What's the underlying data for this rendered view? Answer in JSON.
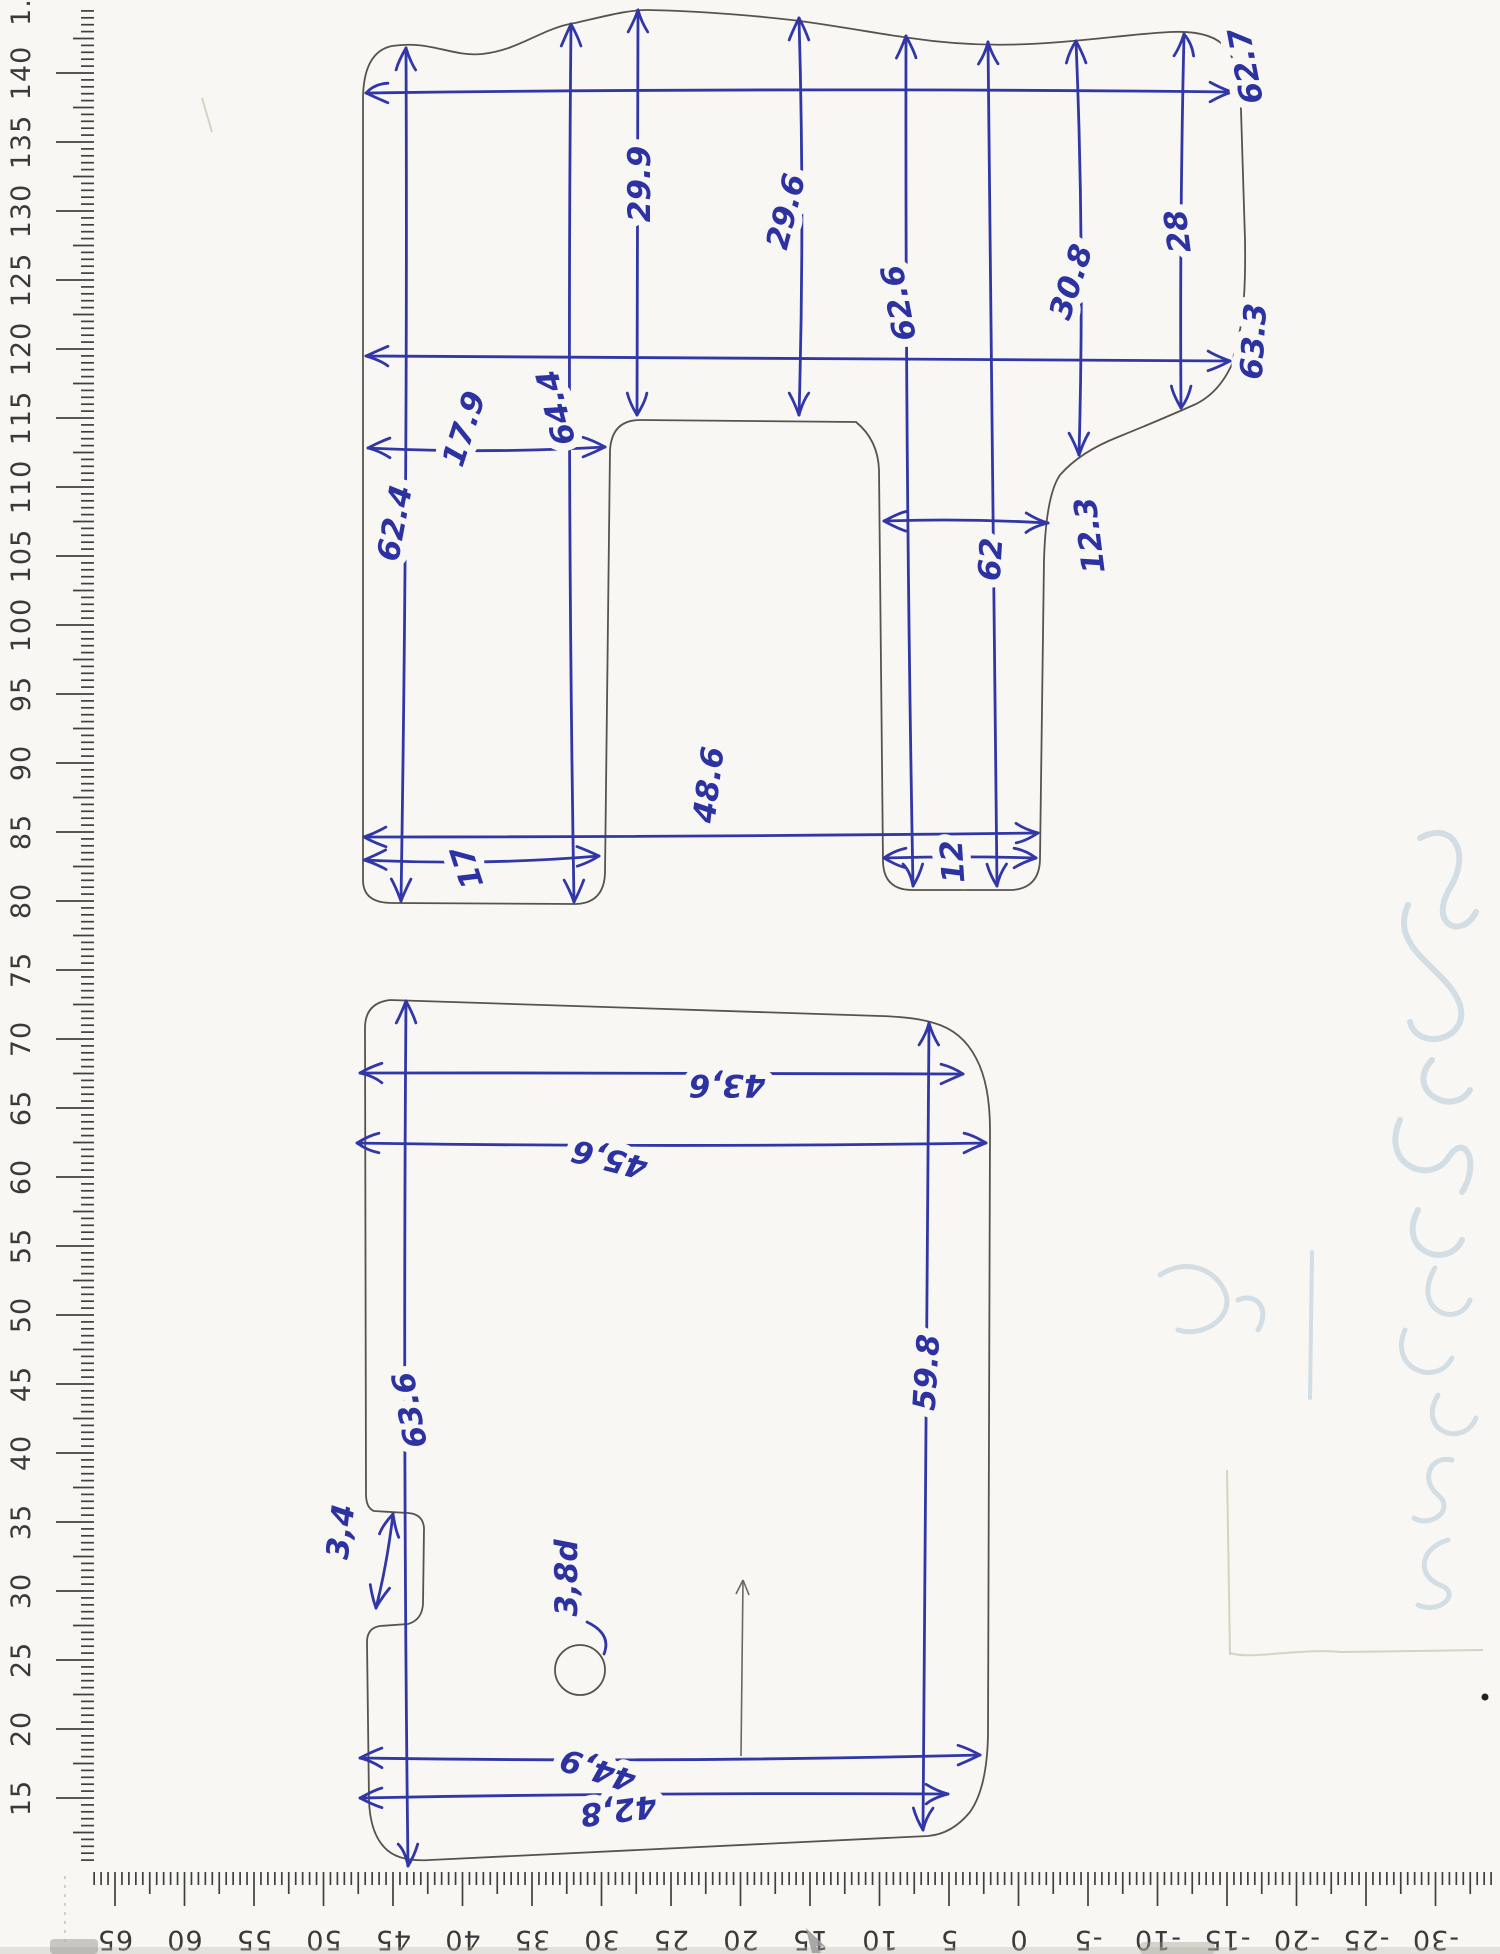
{
  "document": {
    "kind": "scanned hand-drawn template sketch with two outlined parts, dimension arrows and two measuring rulers",
    "ink_color": "#3137a6",
    "pencil_color": "#57544e",
    "paper_color": "#f8f7f3"
  },
  "left_ruler": {
    "orientation": "vertical",
    "partial_top_label": "1",
    "first_value": 140,
    "last_value": 15,
    "step": -5,
    "y_of_first": 73,
    "px_per_unit": 13.8,
    "tick_edge_x": 94,
    "numbers_x": 30,
    "label_rotation": -90,
    "values": [
      140,
      135,
      130,
      125,
      120,
      115,
      110,
      105,
      100,
      95,
      90,
      85,
      80,
      75,
      70,
      65,
      60,
      55,
      50,
      45,
      40,
      35,
      30,
      25,
      20,
      15
    ]
  },
  "bottom_ruler": {
    "orientation": "horizontal",
    "first_value": 65,
    "last_value": -30,
    "step": -5,
    "x_of_45": 393,
    "px_per_unit": 13.9,
    "baseline_y": 1872,
    "numbers_y": 1931,
    "label_rotation": 180,
    "values": [
      65,
      60,
      55,
      50,
      45,
      40,
      35,
      30,
      25,
      20,
      15,
      10,
      5,
      0,
      -5,
      -10,
      -15,
      -20,
      -25,
      -30
    ]
  },
  "top_shape": {
    "name": "upper template outline with slot and two feet",
    "dimensions": [
      {
        "id": "width-top",
        "value": "62.7",
        "x1": 366,
        "y1": 93,
        "x2": 1232,
        "y2": 92,
        "label": {
          "x": 1256,
          "y": 64,
          "rot": -90
        },
        "break": false
      },
      {
        "id": "width-mid",
        "value": "63.3",
        "x1": 366,
        "y1": 356,
        "x2": 1230,
        "y2": 361,
        "label": {
          "x": 1264,
          "y": 342,
          "rot": -90
        },
        "break": false
      },
      {
        "id": "edge-to-slot",
        "value": "17.9",
        "x1": 368,
        "y1": 448,
        "x2": 605,
        "y2": 447,
        "label": {
          "x": 474,
          "y": 432,
          "rot": -90
        },
        "break": true
      },
      {
        "id": "foot2-top-w",
        "value": "12.3",
        "x1": 884,
        "y1": 521,
        "x2": 1048,
        "y2": 523,
        "label": {
          "x": 1100,
          "y": 534,
          "rot": -90
        },
        "break": false
      },
      {
        "id": "width-feet",
        "value": "48.6",
        "x1": 364,
        "y1": 837,
        "x2": 1038,
        "y2": 833,
        "label": {
          "x": 719,
          "y": 786,
          "rot": -90
        },
        "break": true
      },
      {
        "id": "foot1-width",
        "value": "17",
        "x1": 364,
        "y1": 860,
        "x2": 599,
        "y2": 856,
        "label": {
          "x": 477,
          "y": 864,
          "rot": -90
        },
        "break": true
      },
      {
        "id": "foot2-width",
        "value": "12",
        "x1": 884,
        "y1": 858,
        "x2": 1036,
        "y2": 858,
        "label": {
          "x": 963,
          "y": 861,
          "rot": -90
        },
        "break": true
      },
      {
        "id": "height-1",
        "value": "62.4",
        "x1": 406,
        "y1": 48,
        "x2": 401,
        "y2": 901,
        "label": {
          "x": 405,
          "y": 525,
          "rot": -90
        },
        "break": true
      },
      {
        "id": "height-2",
        "value": "64.4",
        "x1": 571,
        "y1": 24,
        "x2": 574,
        "y2": 902,
        "label": {
          "x": 566,
          "y": 405,
          "rot": -90
        },
        "break": true
      },
      {
        "id": "top-to-slot-1",
        "value": "29.9",
        "x1": 638,
        "y1": 10,
        "x2": 637,
        "y2": 415,
        "label": {
          "x": 650,
          "y": 184,
          "rot": -90
        },
        "break": true
      },
      {
        "id": "top-to-slot-2",
        "value": "29.6",
        "x1": 799,
        "y1": 18,
        "x2": 799,
        "y2": 415,
        "label": {
          "x": 796,
          "y": 214,
          "rot": -90
        },
        "break": true
      },
      {
        "id": "height-3",
        "value": "62.6",
        "x1": 906,
        "y1": 36,
        "x2": 913,
        "y2": 886,
        "label": {
          "x": 909,
          "y": 301,
          "rot": -90
        },
        "break": true
      },
      {
        "id": "height-4",
        "value": "62",
        "x1": 988,
        "y1": 42,
        "x2": 997,
        "y2": 886,
        "label": {
          "x": 1001,
          "y": 560,
          "rot": -90
        },
        "break": true
      },
      {
        "id": "top-to-curve-1",
        "value": "30.8",
        "x1": 1076,
        "y1": 41,
        "x2": 1079,
        "y2": 455,
        "label": {
          "x": 1081,
          "y": 285,
          "rot": -90
        },
        "break": true
      },
      {
        "id": "top-to-curve-2",
        "value": "28",
        "x1": 1184,
        "y1": 34,
        "x2": 1181,
        "y2": 408,
        "label": {
          "x": 1188,
          "y": 230,
          "rot": -90
        },
        "break": true
      }
    ]
  },
  "bottom_shape": {
    "name": "lower template outline with side notch and round hole",
    "dimensions": [
      {
        "id": "width-top-1",
        "value": "43,6",
        "x1": 360,
        "y1": 1073,
        "x2": 963,
        "y2": 1074,
        "label": {
          "x": 727,
          "y": 1075,
          "rot": 180
        },
        "break": true
      },
      {
        "id": "width-top-2",
        "value": "45,6",
        "x1": 357,
        "y1": 1143,
        "x2": 986,
        "y2": 1143,
        "label": {
          "x": 612,
          "y": 1149,
          "rot": 180
        },
        "break": true
      },
      {
        "id": "height-left",
        "value": "63.6",
        "x1": 406,
        "y1": 1001,
        "x2": 408,
        "y2": 1866,
        "label": {
          "x": 420,
          "y": 1408,
          "rot": -90
        },
        "break": true
      },
      {
        "id": "height-right",
        "value": "59.8",
        "x1": 929,
        "y1": 1023,
        "x2": 923,
        "y2": 1830,
        "label": {
          "x": 937,
          "y": 1373,
          "rot": -90
        },
        "break": true
      },
      {
        "id": "width-bottom-1",
        "value": "44,9",
        "x1": 360,
        "y1": 1758,
        "x2": 980,
        "y2": 1755,
        "label": {
          "x": 601,
          "y": 1760,
          "rot": 180
        },
        "break": true
      },
      {
        "id": "width-bottom-2",
        "value": "42,8",
        "x1": 360,
        "y1": 1798,
        "x2": 948,
        "y2": 1794,
        "label": {
          "x": 617,
          "y": 1800,
          "rot": 180
        },
        "break": true
      },
      {
        "id": "notch-size",
        "value": "3,4",
        "x1": 393,
        "y1": 1514,
        "x2": 376,
        "y2": 1608,
        "label": {
          "x": 351,
          "y": 1533,
          "rot": -90
        },
        "break": false
      }
    ],
    "hole": {
      "cx": 580,
      "cy": 1670,
      "r": 25,
      "label": "3,8d",
      "label_x": 577,
      "label_y": 1578,
      "label_rot": -90
    }
  },
  "stray_marks": {
    "pencil_guide_line": {
      "x1": 743,
      "y1": 1580,
      "x2": 741,
      "y2": 1756
    },
    "ghost_writing_note": "illegible ink bleed-through from reverse side"
  }
}
